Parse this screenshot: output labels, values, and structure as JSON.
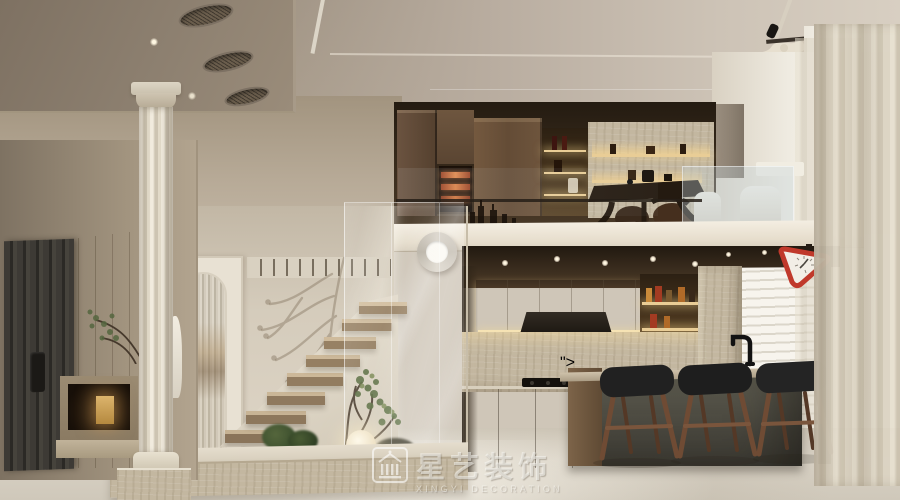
{
  "scene": {
    "type": "interior-design-render",
    "description": "Cream-toned duplex loft: floating stone staircase with glass balustrade, arched reeded-glass door, classical fluted column, open kitchen with travertine backsplash and olive island with three walnut bar stools, mezzanine tea room with backlit walnut cabinetry, floor-to-ceiling window with sheer curtains, red triangular accent clock"
  },
  "watermark": {
    "logo_icon": "classical-building-icon",
    "title": "星艺装饰",
    "subtitle": "XINGYI DECORATION"
  },
  "colors": {
    "ceiling_taupe": "#9a8c7c",
    "wall_beige": "#c9beae",
    "kitchen_box_cream": "#e9e2d3",
    "loft_walnut": "#5f4a36",
    "travertine": "#c3b7a0",
    "island_olive": "#55534a",
    "countertop_taupe": "#b3a48e",
    "stool_seat_black": "#222222",
    "stool_leg_walnut": "#6f4b34",
    "accent_clock_red": "#c0392b",
    "wine_glow_amber": "#d4713d",
    "curtain_cream": "#d9d0bf",
    "floor_greige": "#d5cec1",
    "window_light": "#fdfcf9"
  }
}
